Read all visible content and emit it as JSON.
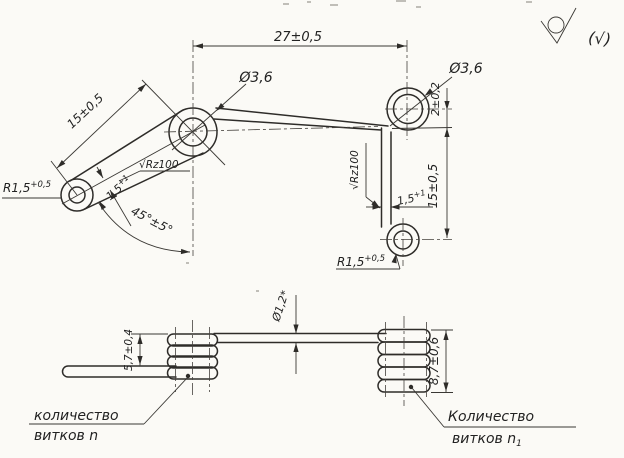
{
  "drawing": {
    "surface_finish": {
      "note_parenthesized": "(√)"
    },
    "top_view": {
      "dim_span": "27±0,5",
      "loop_dia_left": "Ø3,6",
      "loop_dia_right": "Ø3,6",
      "arm_length": "15±0,5",
      "arm_angle": "45°±5°",
      "end_radius_left": {
        "base": "R1,5",
        "sup": "+0,5"
      },
      "end_radius_right": {
        "base": "R1,5",
        "sup": "+0,5"
      },
      "wire_width_left": {
        "base": "1,5",
        "sup": "+1"
      },
      "wire_width_right": {
        "base": "1,5",
        "sup": "+1"
      },
      "roughness_left": "√Rz100",
      "roughness_right": "√Rz100",
      "offset_right": "2±0,2",
      "leg_length_right": "15±0,5"
    },
    "bottom_view": {
      "wire_dia": "Ø1,2*",
      "coil_height_left": "5,7±0,4",
      "coil_height_right": "8,7±0,6",
      "callout_left": {
        "line1": "количество",
        "line2": "витков n"
      },
      "callout_right": {
        "line1": "Количество",
        "line2": "витков n",
        "sub": "1"
      }
    }
  }
}
